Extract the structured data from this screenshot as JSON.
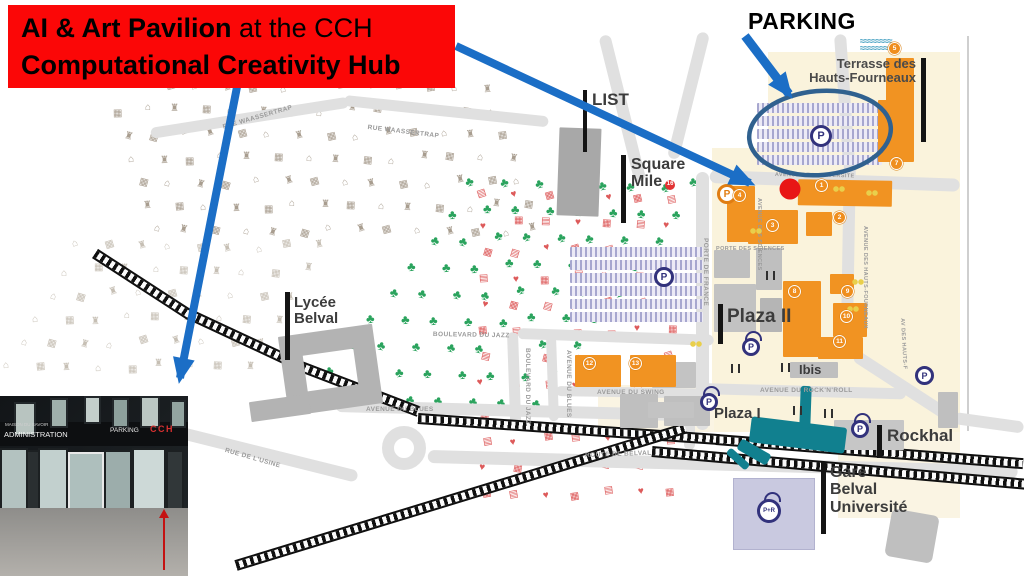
{
  "banner": {
    "line1_bold": "AI & Art Pavilion",
    "line1_rest": " at the CCH",
    "line2_bold": "Computational Creativity Hub",
    "bg": "#fb0707",
    "fg": "#000000"
  },
  "callouts": {
    "parking_title": "PARKING",
    "arrow_color": "#1b6ec6",
    "ellipse_color": "#30618f",
    "marker_dot_color": "#e81616"
  },
  "map": {
    "labels": {
      "list": "LIST",
      "square_1": "Square",
      "square_2": "Mile",
      "terrasse_1": "Terrasse des",
      "terrasse_2": "Hauts-Fourneaux",
      "lycee_1": "Lycée",
      "lycee_2": "Belval",
      "plaza2": "Plaza II",
      "ibis": "Ibis",
      "plaza1": "Plaza I",
      "rockhal": "Rockhal",
      "gare_1": "Gare",
      "gare_2": "Belval",
      "gare_3": "Université"
    },
    "square_mile_badge": "16",
    "streets": {
      "waassertrap": "RUE WAASSERTRAP",
      "jazz": "BOULEVARD DU JAZZ",
      "blues": "AVENUE DU BLUES",
      "swing": "AVENUE DU SWING",
      "rocknroll": "AVENUE DU ROCK'N'ROLL",
      "belval": "ROUTE DE BELVAL",
      "usine": "RUE DE L'USINE",
      "porte_france": "PORTE DE FRANCE",
      "porte_sciences": "PORTE DES SCIENCES",
      "sciences": "AVENUE DES SCIENCES",
      "universite": "AVENUE DE L'UNIVERSITE",
      "hauts_fourneaux": "AVENUE DES HAUTS-FOURNEAUX",
      "hauts_f": "AV DES HAUTS-F"
    },
    "markers": {
      "p": "P",
      "pr": "P+R"
    },
    "badges": {
      "b1": "1",
      "b2": "2",
      "b3": "3",
      "b4": "4",
      "b5": "5",
      "b7": "7",
      "b8": "8",
      "b9": "9",
      "b10": "10",
      "b11": "11",
      "b12": "12",
      "b13": "13"
    },
    "icon_zones": {
      "residential": {
        "glyphs": [
          "⌂",
          "♜",
          "▦"
        ],
        "color": "#a89d8f",
        "size": 10
      },
      "residential_light": {
        "glyphs": [
          "⌂",
          "▦",
          "♜"
        ],
        "color": "#c6bfb4",
        "size": 10
      },
      "park": {
        "glyphs": [
          "♣"
        ],
        "color": "#2aa35d",
        "size": 13
      },
      "district_red": {
        "glyphs": [
          "▤",
          "♥",
          "▦"
        ],
        "color": "#dd5a5a",
        "size": 10
      }
    }
  },
  "photo": {
    "signs": {
      "maison": "MAISON DU SAVOIR",
      "administration": "ADMINISTRATION",
      "parking": "PARKING",
      "cch": "CCH"
    }
  }
}
